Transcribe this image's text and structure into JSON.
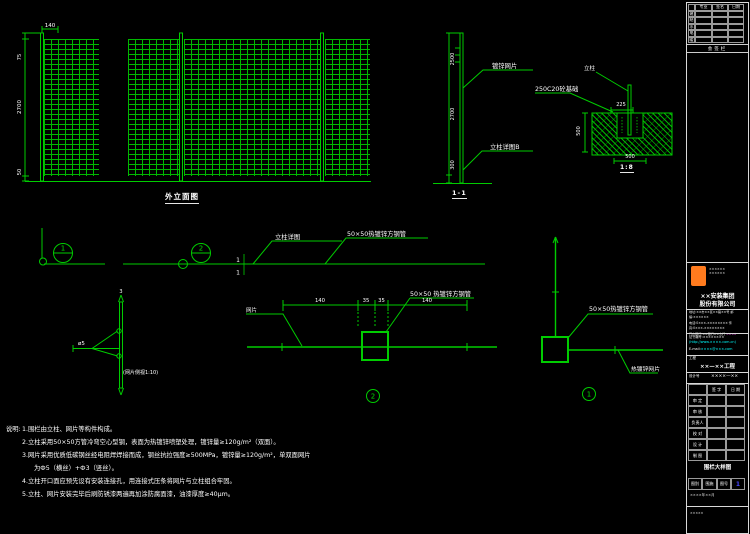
{
  "colors": {
    "line_green": "#00cc00",
    "grid_green": "#00b800",
    "text_white": "#ffffff",
    "cyan": "#00ffff",
    "magenta": "#ff55ff",
    "logo_orange": "#ff7b1e",
    "blue": "#4444ff"
  },
  "elevation": {
    "caption": "外立面图",
    "dim_top_width": "140",
    "dim_top": "75",
    "dim_height": "2700",
    "dim_bottom": "50"
  },
  "section": {
    "caption": "1-1",
    "leader_mesh": "镀锌网片",
    "leader_post": "立柱详图B",
    "dim_upper": "2500",
    "dim_mid": "2700",
    "dim_bottom": "300"
  },
  "foundation": {
    "caption": "1:8",
    "leader_concrete": "250C20砼基础",
    "label_post": "立柱",
    "dim_slot": "225",
    "dim_depth": "500",
    "dim_width": "500"
  },
  "plan": {
    "bubble1": "1",
    "bubble2": "2",
    "cut_top": "1",
    "cut_bottom": "1",
    "leader_detail": "立柱详图",
    "leader_pipe": "50×50热镀锌方钢管"
  },
  "sideview": {
    "top_label": "3",
    "wire_label": "ø5",
    "caption": "(网片侧视1:10)"
  },
  "detail2": {
    "bubble": "2",
    "leader_pipe": "50×50 热镀锌方钢管",
    "label_mesh": "网片",
    "dim1": "140",
    "dim2": "35",
    "dim3": "35",
    "dim4": "140"
  },
  "detail1": {
    "bubble": "1",
    "leader_pipe": "50×50热镀锌方钢管",
    "leader_mesh": "热镀锌网片"
  },
  "notes": {
    "label": "说明:",
    "line1": "1.围栏由立柱、网片等构件构成。",
    "line2": "2.立柱采用50×50方管冷弯空心型钢，表面为热镀锌喷塑处理，镀锌量≥120g/m²（双面）。",
    "line3": "3.网片采用优质低碳钢丝经电阻焊焊接而成，钢丝抗拉强度≥500MPa，镀锌量≥120g/m²，单双面网片",
    "line4": "为Ф5（横丝）+Ф3（竖丝）。",
    "line5": "4.立柱开口面应预先设有安装连接孔，用连接式压条将网片与立柱组合牢固。",
    "line6": "5.立柱、网片安装完毕后刷防锈漆两遍再加涂防腐面漆，油漆厚度≥40μm。"
  },
  "titleblock": {
    "sign": {
      "headers": [
        "专业",
        "签名",
        "日期"
      ],
      "rows": [
        "建",
        "结",
        "水",
        "电",
        "暖"
      ],
      "bar": "会签栏"
    },
    "company": {
      "logo_side1": "××××××",
      "logo_side2": "××××××",
      "name1": "××安装集团",
      "name2": "股份有限公司",
      "addr1": "地址:××市××区××路××号 邮编:××××××",
      "addr2": "电话:0×××-×××××××× 传真:0×××-××××××××",
      "addr3": "开户银行:××银行××支行 ",
      "addr3m": "××××",
      "cert": "证书编号:××××××××",
      "web": "(http://www.××××.com.cn)",
      "mail_label": "E-mail:",
      "mail": "××××@×××.com"
    },
    "project": {
      "label": "工程",
      "value": "××—××工程",
      "design_label": "设计号",
      "design_value": "××××—××"
    },
    "staff": {
      "h1": "签 字",
      "h2": "日 期",
      "rows": [
        "审 定",
        "审 核",
        "负责人",
        "校 对",
        "设 计",
        "制 图"
      ]
    },
    "drawing_title": "围栏大样图",
    "info": {
      "c1": "图别",
      "c2": "围施",
      "c3": "图号",
      "c4": "1"
    },
    "footer1": "××××年××月",
    "footer2": "×××××"
  }
}
